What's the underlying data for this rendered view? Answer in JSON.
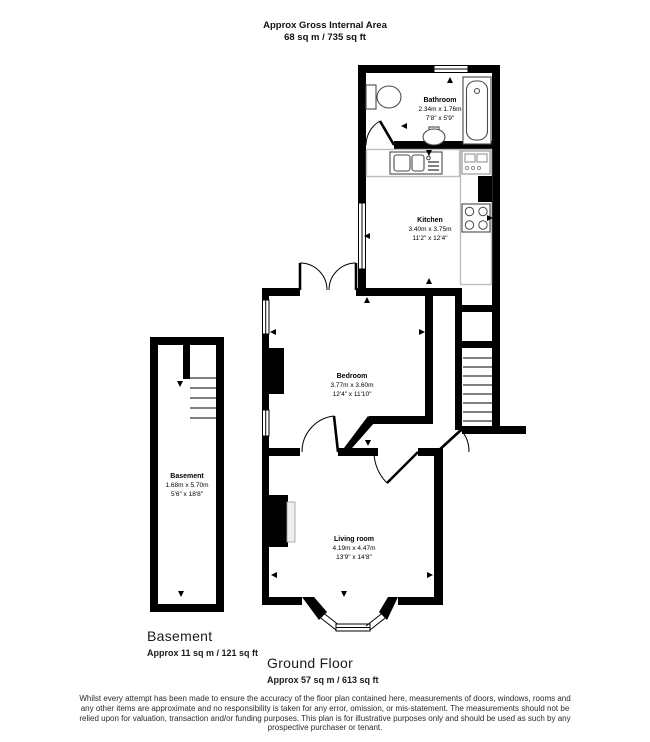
{
  "header": {
    "line1": "Approx Gross Internal Area",
    "line2": "68 sq m / 735 sq ft"
  },
  "rooms": {
    "bathroom": {
      "name": "Bathroom",
      "metric": "2.34m x 1.76m",
      "imperial": "7'8\" x 5'9\""
    },
    "kitchen": {
      "name": "Kitchen",
      "metric": "3.40m x 3.75m",
      "imperial": "11'2\" x 12'4\""
    },
    "bedroom": {
      "name": "Bedroom",
      "metric": "3.77m x 3.60m",
      "imperial": "12'4\" x 11'10\""
    },
    "basement": {
      "name": "Basement",
      "metric": "1.68m x 5.70m",
      "imperial": "5'6\" x 18'8\""
    },
    "living_room": {
      "name": "Living room",
      "metric": "4.19m x 4.47m",
      "imperial": "13'9\" x 14'8\""
    }
  },
  "floors": {
    "basement": {
      "label": "Basement",
      "area": "Approx 11 sq m / 121 sq ft"
    },
    "ground": {
      "label": "Ground Floor",
      "area": "Approx 57 sq m / 613 sq ft"
    }
  },
  "disclaimer": {
    "lines": [
      "Whilst every attempt has been made to ensure the accuracy of the floor plan contained here, measurements of doors, windows, rooms and",
      "any other items are approximate and no responsibility is taken for any error, omission, or mis-statement. The measurements should not be",
      "relied upon for valuation, transaction and/or funding purposes. This plan is for illustrative purposes only and should be used as such by any",
      "prospective purchaser or tenant."
    ]
  },
  "colors": {
    "wall": "#000000",
    "fixture": "#4a4a4a",
    "counter": "#bdbdbd"
  }
}
